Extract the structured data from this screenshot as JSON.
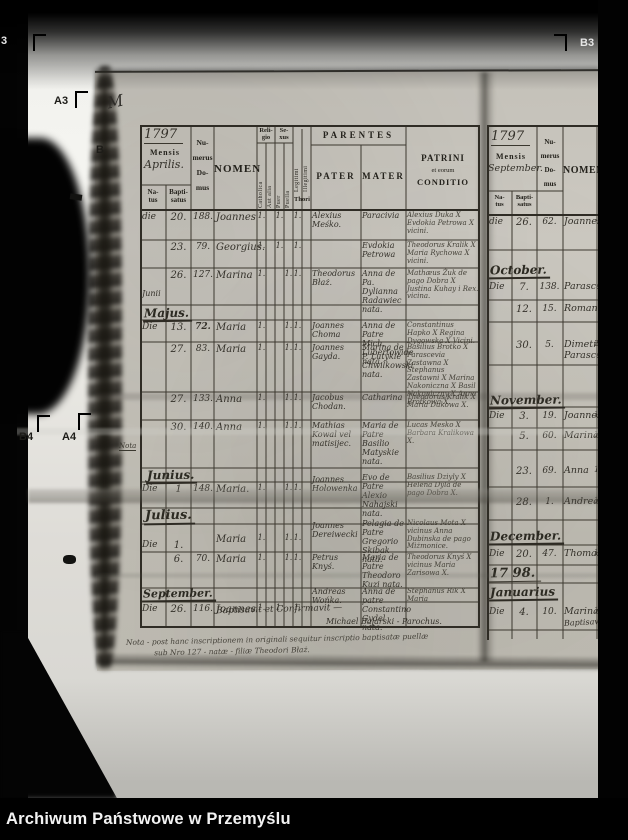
{
  "colors": {
    "film": "#ebeae6",
    "paper": "#c7c4bb",
    "ink": "#2f2d26",
    "caption_bg": "#000000",
    "caption_fg": "#f2f2f2"
  },
  "markers": {
    "top_left": "3",
    "top_right": "B3",
    "a3": "A3",
    "b": "B",
    "b4": "B4",
    "a4": "A4",
    "m_scribble": "M",
    "nota": "Nota"
  },
  "caption": "Archiwum Państwowe w Przemyślu",
  "left": {
    "year": "1797",
    "header": {
      "mensis": "Mensis",
      "month": "Aprilis.",
      "natus": "Na-\ntus",
      "baptisatus": "Bapti-\nsatus",
      "numerus": "Nu-\nmerus\nDo-\nmus",
      "nomen": "NOMEN",
      "religio": "Reli-\ngio",
      "catholica": "Catholica",
      "aut_alia": "Aut alia",
      "sexus": "Se-\nxus",
      "puer": "Puer",
      "puella": "Puella",
      "legitimi": "Legitimi",
      "illegitimi": "Illegitimi",
      "thori": "Thori",
      "parentes": "PARENTES",
      "pater": "PATER",
      "mater": "MATER",
      "patrini_1": "PATRINI",
      "patrini_2": "et eorum",
      "patrini_3": "CONDITIO"
    },
    "sections": {
      "majus": "Majus.",
      "junius": "Junius.",
      "julius": "Julius.",
      "september": "September."
    },
    "rows": [
      {
        "die": "die",
        "day": "20.",
        "num": "188.",
        "nomen": "Joannes",
        "m1": "1.",
        "m2": "1.",
        "m3": "1.",
        "pater": "Alexius Meśko.",
        "mater": "Paracivia",
        "patrini": "Alexius Duka X Evdokia Petrowa X vicini."
      },
      {
        "die": "",
        "day": "23.",
        "num": "79.",
        "nomen": "Georgius.",
        "m1": "1.",
        "m2": "1.",
        "m3": "1.",
        "pater": "",
        "mater": "Evdokia Petrowa",
        "patrini": "Theodorus Kralik X Maria Rychowa X vicini."
      },
      {
        "die": "",
        "die2": "Junii",
        "day": "26.",
        "num": "127.",
        "nomen": "Marina",
        "m1": "1.",
        "m2": "1.",
        "m3": "1.",
        "pater": "Theodorus Błaż.",
        "mater": "Anna de Pa. Dylianna Radawiec nata.",
        "patrini": "Mathæus Żuk de pago Dobra X Justina Kuhay i Rex. vicina."
      },
      {
        "die": "Die",
        "day": "13.",
        "num": "72.",
        "nomen": "Maria",
        "m1": "1.",
        "m2": "1.",
        "m3": "1.",
        "pater": "Joannes Choma",
        "mater": "Anna de Patre Mich. Lubertowide nata.",
        "patrini": "Constantinus Hapko X Regina Dygowska X Vicini."
      },
      {
        "die": "",
        "day": "27.",
        "num": "83.",
        "nomen": "Maria",
        "m1": "1.",
        "m2": "1.",
        "m3": "1.",
        "pater": "Joannes Gayda.",
        "mater": "Marina de P. Lutykie Chwilkowski nata.",
        "patrini": "Basilius Brotko X Parascevia Zastawna X Stephanus Zastawni X Marina Nakoniczna X Basil Nakoniczny X Anna Brotkowa X."
      },
      {
        "die": "",
        "day": "27.",
        "num": "133.",
        "nomen": "Anna",
        "m1": "1.",
        "m2": "1.",
        "m3": "1.",
        "pater": "Jacobus Chodan.",
        "mater": "Catharina",
        "patrini": "Theodorus Kralik X Maria Dukowa X."
      },
      {
        "die": "",
        "day": "30.",
        "num": "140.",
        "nomen": "Anna",
        "m1": "1.",
        "m2": "1.",
        "m3": "1.",
        "pater": "Mathias Kowal vel matisijec.",
        "mater": "Maria de Patre Basilio Matyskie nata.",
        "patrini": "Lucas Mesko X Barbara Kralikowa X."
      },
      {
        "die": "Die",
        "day": "1",
        "num": "148.",
        "nomen": "Maria.",
        "m1": "1.",
        "m2": "1.",
        "m3": "1.",
        "pater": "Joannes Holowenka",
        "mater": "Evo de Patre Alexio Nahajski nata.",
        "patrini": "Basilius Dziyly X Helena Dyla de pago Dobra X."
      },
      {
        "die": "Die",
        "day": "1.",
        "num": "",
        "nomen": "Maria",
        "m1": "1.",
        "m2": "1.",
        "m3": "1.",
        "pater": "Joannes Dereiwecki",
        "mater": "Pelagia de Patre Gregorio Skibak nata.",
        "patrini": "Nicolaus Mota X vicinus Anna Dubinska de pago Miżmonice."
      },
      {
        "die": "",
        "day": "6.",
        "num": "70.",
        "nomen": "Maria",
        "m1": "1.",
        "m2": "1.",
        "m3": "1.",
        "pater": "Petrus Knyś.",
        "mater": "Maria de Patre Theodoro Kuzi nata.",
        "patrini": "Theodorus Knyś X vicinus Maria Zarisowa X."
      },
      {
        "die": "Die",
        "day": "26.",
        "num": "116.",
        "nomen": "Joannes",
        "m1": "1.",
        "m2": "1.",
        "m3": "1.",
        "pater": "Andreas Wońka.",
        "mater": "Anna de patre Constantino Gydel nata.",
        "patrini": "Stephanus Rik X Maria"
      }
    ],
    "baptisavit": "Baptisavit et Confirmavit —",
    "parochus": "Michael Bajarski - Parochus.",
    "note_1": "Nota - post hanc inscriptionem in originali sequitur inscriptio baptisatæ puellæ",
    "note_2": "sub Nro 127 - natæ - filiæ Theodori Błaż."
  },
  "right": {
    "year": "1797",
    "header": {
      "mensis": "Mensis",
      "month": "September.",
      "natus": "Na-\ntus",
      "baptisatus": "Bapti-\nsatus",
      "numerus": "Nu-\nmerus\nDo-\nmus",
      "nomen": "NOMEN"
    },
    "sections": {
      "october": "October.",
      "november": "November.",
      "december": "December.",
      "januarius": "Januarius",
      "year_change": "17 98."
    },
    "rows": [
      {
        "die": "die",
        "day": "26.",
        "num": "62.",
        "nomen": "Joannes",
        "rel": ""
      },
      {
        "die": "Die",
        "day": "7.",
        "num": "138.",
        "nomen": "Parascevia",
        "rel": ""
      },
      {
        "die": "",
        "day": "12.",
        "num": "15.",
        "nomen": "Romanus",
        "rel": ""
      },
      {
        "die": "",
        "day": "30.",
        "num": "5.",
        "nomen": "Dimetrius Parascevia",
        "rel": "2"
      },
      {
        "die": "Die",
        "day": "3.",
        "num": "19.",
        "nomen": "Joannes",
        "rel": "1"
      },
      {
        "die": "",
        "day": "5.",
        "num": "60.",
        "nomen": "Marina",
        "rel": "1"
      },
      {
        "die": "",
        "day": "23.",
        "num": "69.",
        "nomen": "Anna",
        "rel": "1"
      },
      {
        "die": "",
        "day": "28.",
        "num": "1.",
        "nomen": "Andreas",
        "rel": "1."
      },
      {
        "die": "Die",
        "day": "20.",
        "num": "47.",
        "nomen": "Thomas",
        "rel": "1"
      },
      {
        "die": "Die",
        "day": "4.",
        "num": "10.",
        "nomen": "Marina",
        "rel": "1"
      }
    ],
    "baptisavit": "Baptisavit"
  }
}
